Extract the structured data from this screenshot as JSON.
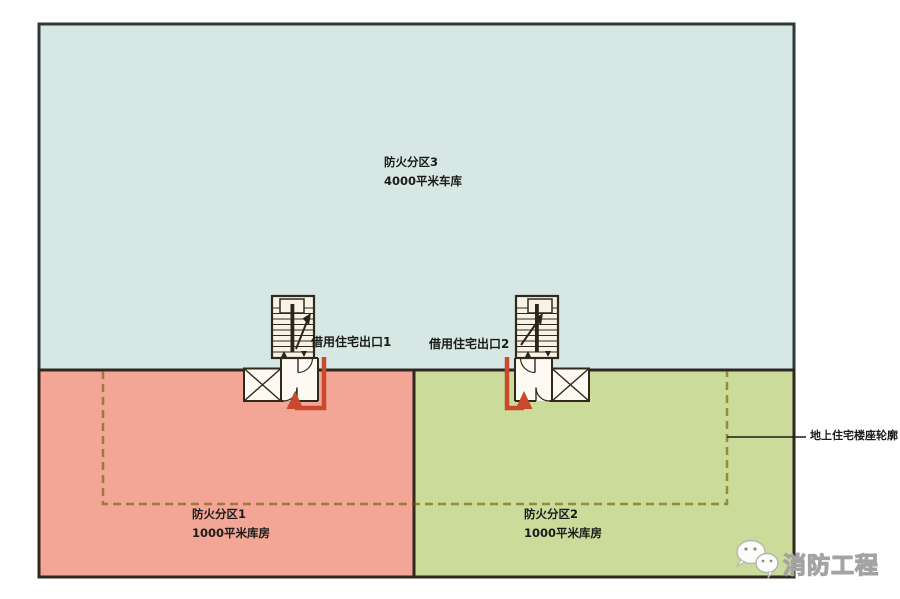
{
  "zones": [
    {
      "name": "防火分区3",
      "area": "4000平米车库",
      "color": "#d7e8e4"
    },
    {
      "name": "防火分区1",
      "area": "1000平米库房",
      "color": "#f3a695"
    },
    {
      "name": "防火分区2",
      "area": "1000平米库房",
      "color": "#cbdb99"
    }
  ],
  "exits": [
    {
      "label": "借用住宅出口1"
    },
    {
      "label": "借用住宅出口2"
    }
  ],
  "building_outline": {
    "label": "地上住宅楼座轮廓",
    "color": "rgba(112,90,10,0.62)"
  },
  "watermark": {
    "text": "消防工程",
    "icon": "wechat-chat-bubbles-icon"
  },
  "colors": {
    "arrow_red": "#c8492e",
    "wall_dark": "#32291d",
    "blue_border": "#2c3a3a",
    "stair_fill": "#f7f2e6",
    "room_fill": "#fcfaf3",
    "line_black": "#1c1c1c"
  }
}
